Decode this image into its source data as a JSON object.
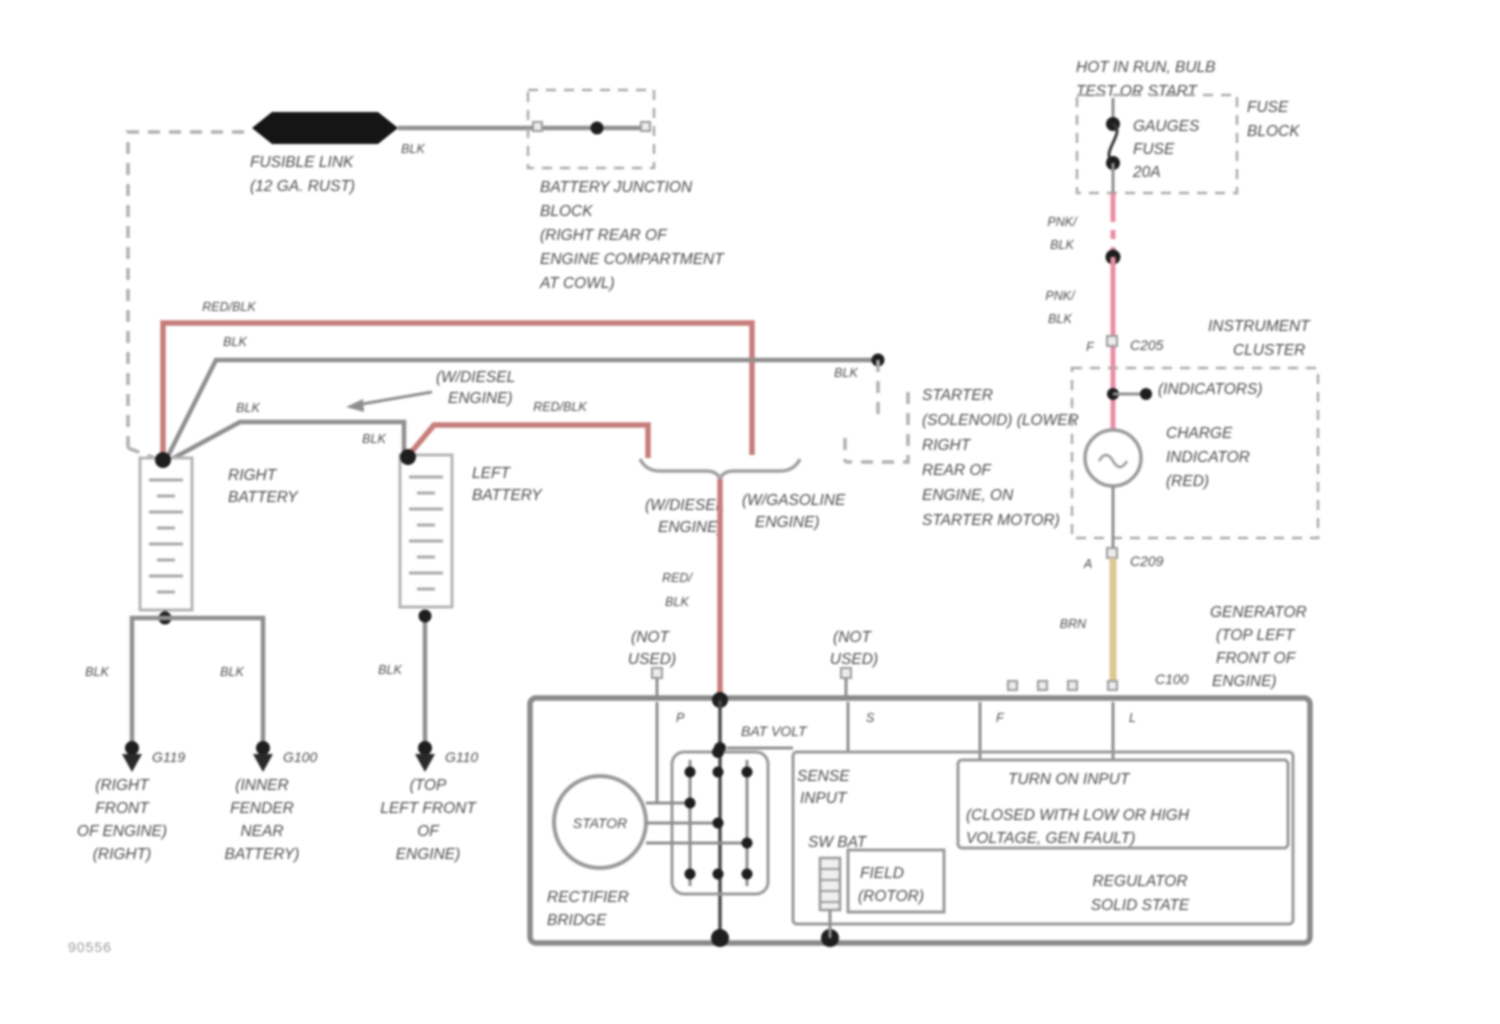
{
  "page": {
    "code": "90556"
  },
  "top_left": {
    "fusible_link_lines": [
      "FUSIBLE LINK",
      "(12 GA. RUST)"
    ],
    "blk": "BLK",
    "junction_block_lines": [
      "BATTERY JUNCTION",
      "BLOCK",
      "(RIGHT REAR OF",
      "ENGINE COMPARTMENT",
      "AT COWL)"
    ]
  },
  "feed": {
    "red_blk": "RED/BLK",
    "blk_upper": "BLK",
    "blk_diag": "BLK",
    "blk_near_left_battery": "BLK",
    "red_blk_left": "RED/BLK",
    "blk_at_solenoid": "BLK"
  },
  "batteries": {
    "right_lines": [
      "RIGHT",
      "BATTERY"
    ],
    "left_lines": [
      "LEFT",
      "BATTERY"
    ],
    "gnd1_blk": "BLK",
    "gnd2_blk": "BLK",
    "gnd3_blk": "BLK"
  },
  "variants": {
    "diesel_callout_lines": [
      "(W/DIESEL",
      "ENGINE)"
    ],
    "diesel_lines": [
      "(W/DIESEL",
      "ENGINE)"
    ],
    "gasoline_lines": [
      "(W/GASOLINE",
      "ENGINE)"
    ]
  },
  "center": {
    "red_lines": [
      "RED/",
      "BLK"
    ],
    "not_used_1": [
      "(NOT",
      "USED)"
    ],
    "not_used_2": [
      "(NOT",
      "USED)"
    ]
  },
  "starter": {
    "lines": [
      "STARTER",
      "(SOLENOID) (LOWER",
      "RIGHT",
      "REAR OF",
      "ENGINE, ON",
      "STARTER MOTOR)"
    ]
  },
  "grounds": {
    "g1_id": "G119",
    "g1_lines": [
      "(RIGHT",
      "FRONT",
      "OF ENGINE)",
      "(RIGHT)"
    ],
    "g2_id": "G100",
    "g2_lines": [
      "(INNER",
      "FENDER",
      "NEAR",
      "BATTERY)"
    ],
    "g3_id": "G110",
    "g3_lines": [
      "(TOP",
      "LEFT FRONT",
      "OF",
      "ENGINE)"
    ]
  },
  "fuse_area": {
    "hot_lines": [
      "HOT IN RUN, BULB",
      "TEST OR START"
    ],
    "fuse_lines": [
      "GAUGES",
      "FUSE",
      "20A"
    ],
    "block_lines": [
      "FUSE",
      "BLOCK"
    ],
    "pnk1_lines": [
      "PNK/",
      "BLK"
    ],
    "pnk2_lines": [
      "PNK/",
      "BLK"
    ]
  },
  "cluster": {
    "name_lines": [
      "INSTRUMENT",
      "CLUSTER"
    ],
    "indicators": "(INDICATORS)",
    "charge_lines": [
      "CHARGE",
      "INDICATOR",
      "(RED)"
    ],
    "term_in": "F",
    "conn_in": "C205",
    "term_out": "A",
    "conn_out": "C209",
    "brn": "BRN"
  },
  "generator": {
    "name_lines": [
      "GENERATOR",
      "(TOP LEFT",
      "FRONT OF",
      "ENGINE)"
    ],
    "conn": "C100",
    "bat_volt": "BAT VOLT",
    "stator": "STATOR",
    "rectifier_lines": [
      "RECTIFIER",
      "BRIDGE"
    ],
    "sense_lines": [
      "SENSE",
      "INPUT"
    ],
    "sw_bat": "SW BAT",
    "field_lines": [
      "FIELD",
      "(ROTOR)"
    ],
    "turn_on": "TURN ON INPUT",
    "closed_lines": [
      "(CLOSED WITH LOW OR HIGH",
      "VOLTAGE, GEN FAULT)"
    ],
    "regulator_lines": [
      "REGULATOR",
      "SOLID STATE"
    ],
    "term_p": "P",
    "term_s": "S",
    "term_f": "F",
    "term_l": "L"
  }
}
